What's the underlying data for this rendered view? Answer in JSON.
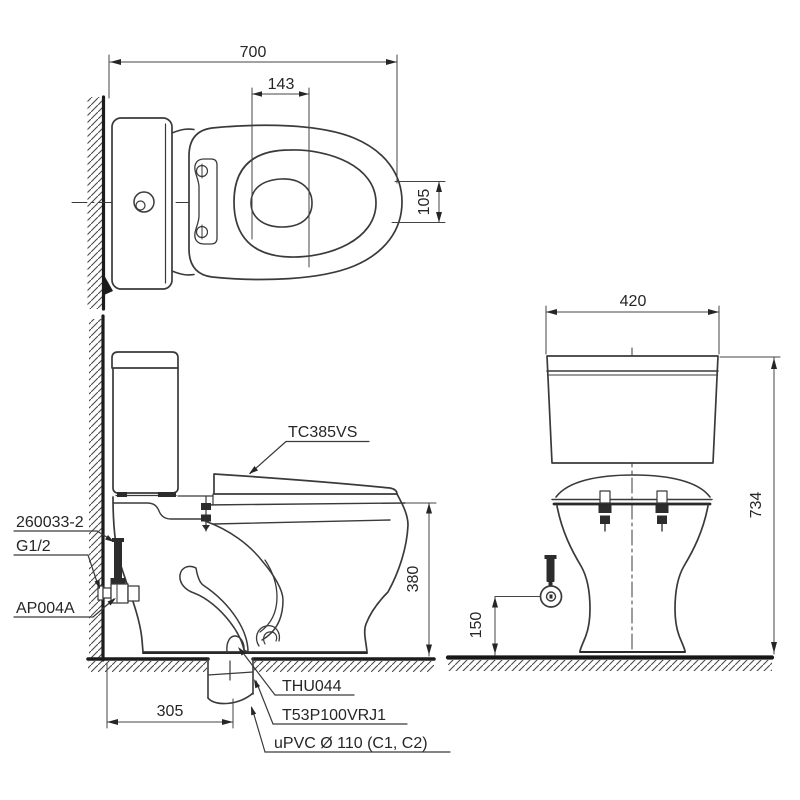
{
  "drawing": {
    "type": "technical-installation-drawing",
    "subject": "two-piece toilet, three orthographic views",
    "top_view": {
      "dim_length": "700",
      "dim_seat_cutout": "143",
      "dim_offset": "105"
    },
    "side_view": {
      "label_seat_model": "TC385VS",
      "label_fill_valve": "260033-2",
      "label_thread": "G1/2",
      "label_stop_valve": "AP004A",
      "dim_rim_height": "380",
      "dim_outlet_setout": "305",
      "label_outlet_flange": "THU044",
      "label_bowl_model": "T53P100VRJ1",
      "label_drain_pipe": "uPVC Ø 110 (C1, C2)"
    },
    "front_view": {
      "dim_tank_width": "420",
      "dim_overall_height": "734",
      "dim_valve_height": "150"
    }
  },
  "colors": {
    "line": "#3a3a3a",
    "heavy": "#1c1c1c",
    "dim": "#444444",
    "text": "#262626",
    "background": "#ffffff"
  }
}
